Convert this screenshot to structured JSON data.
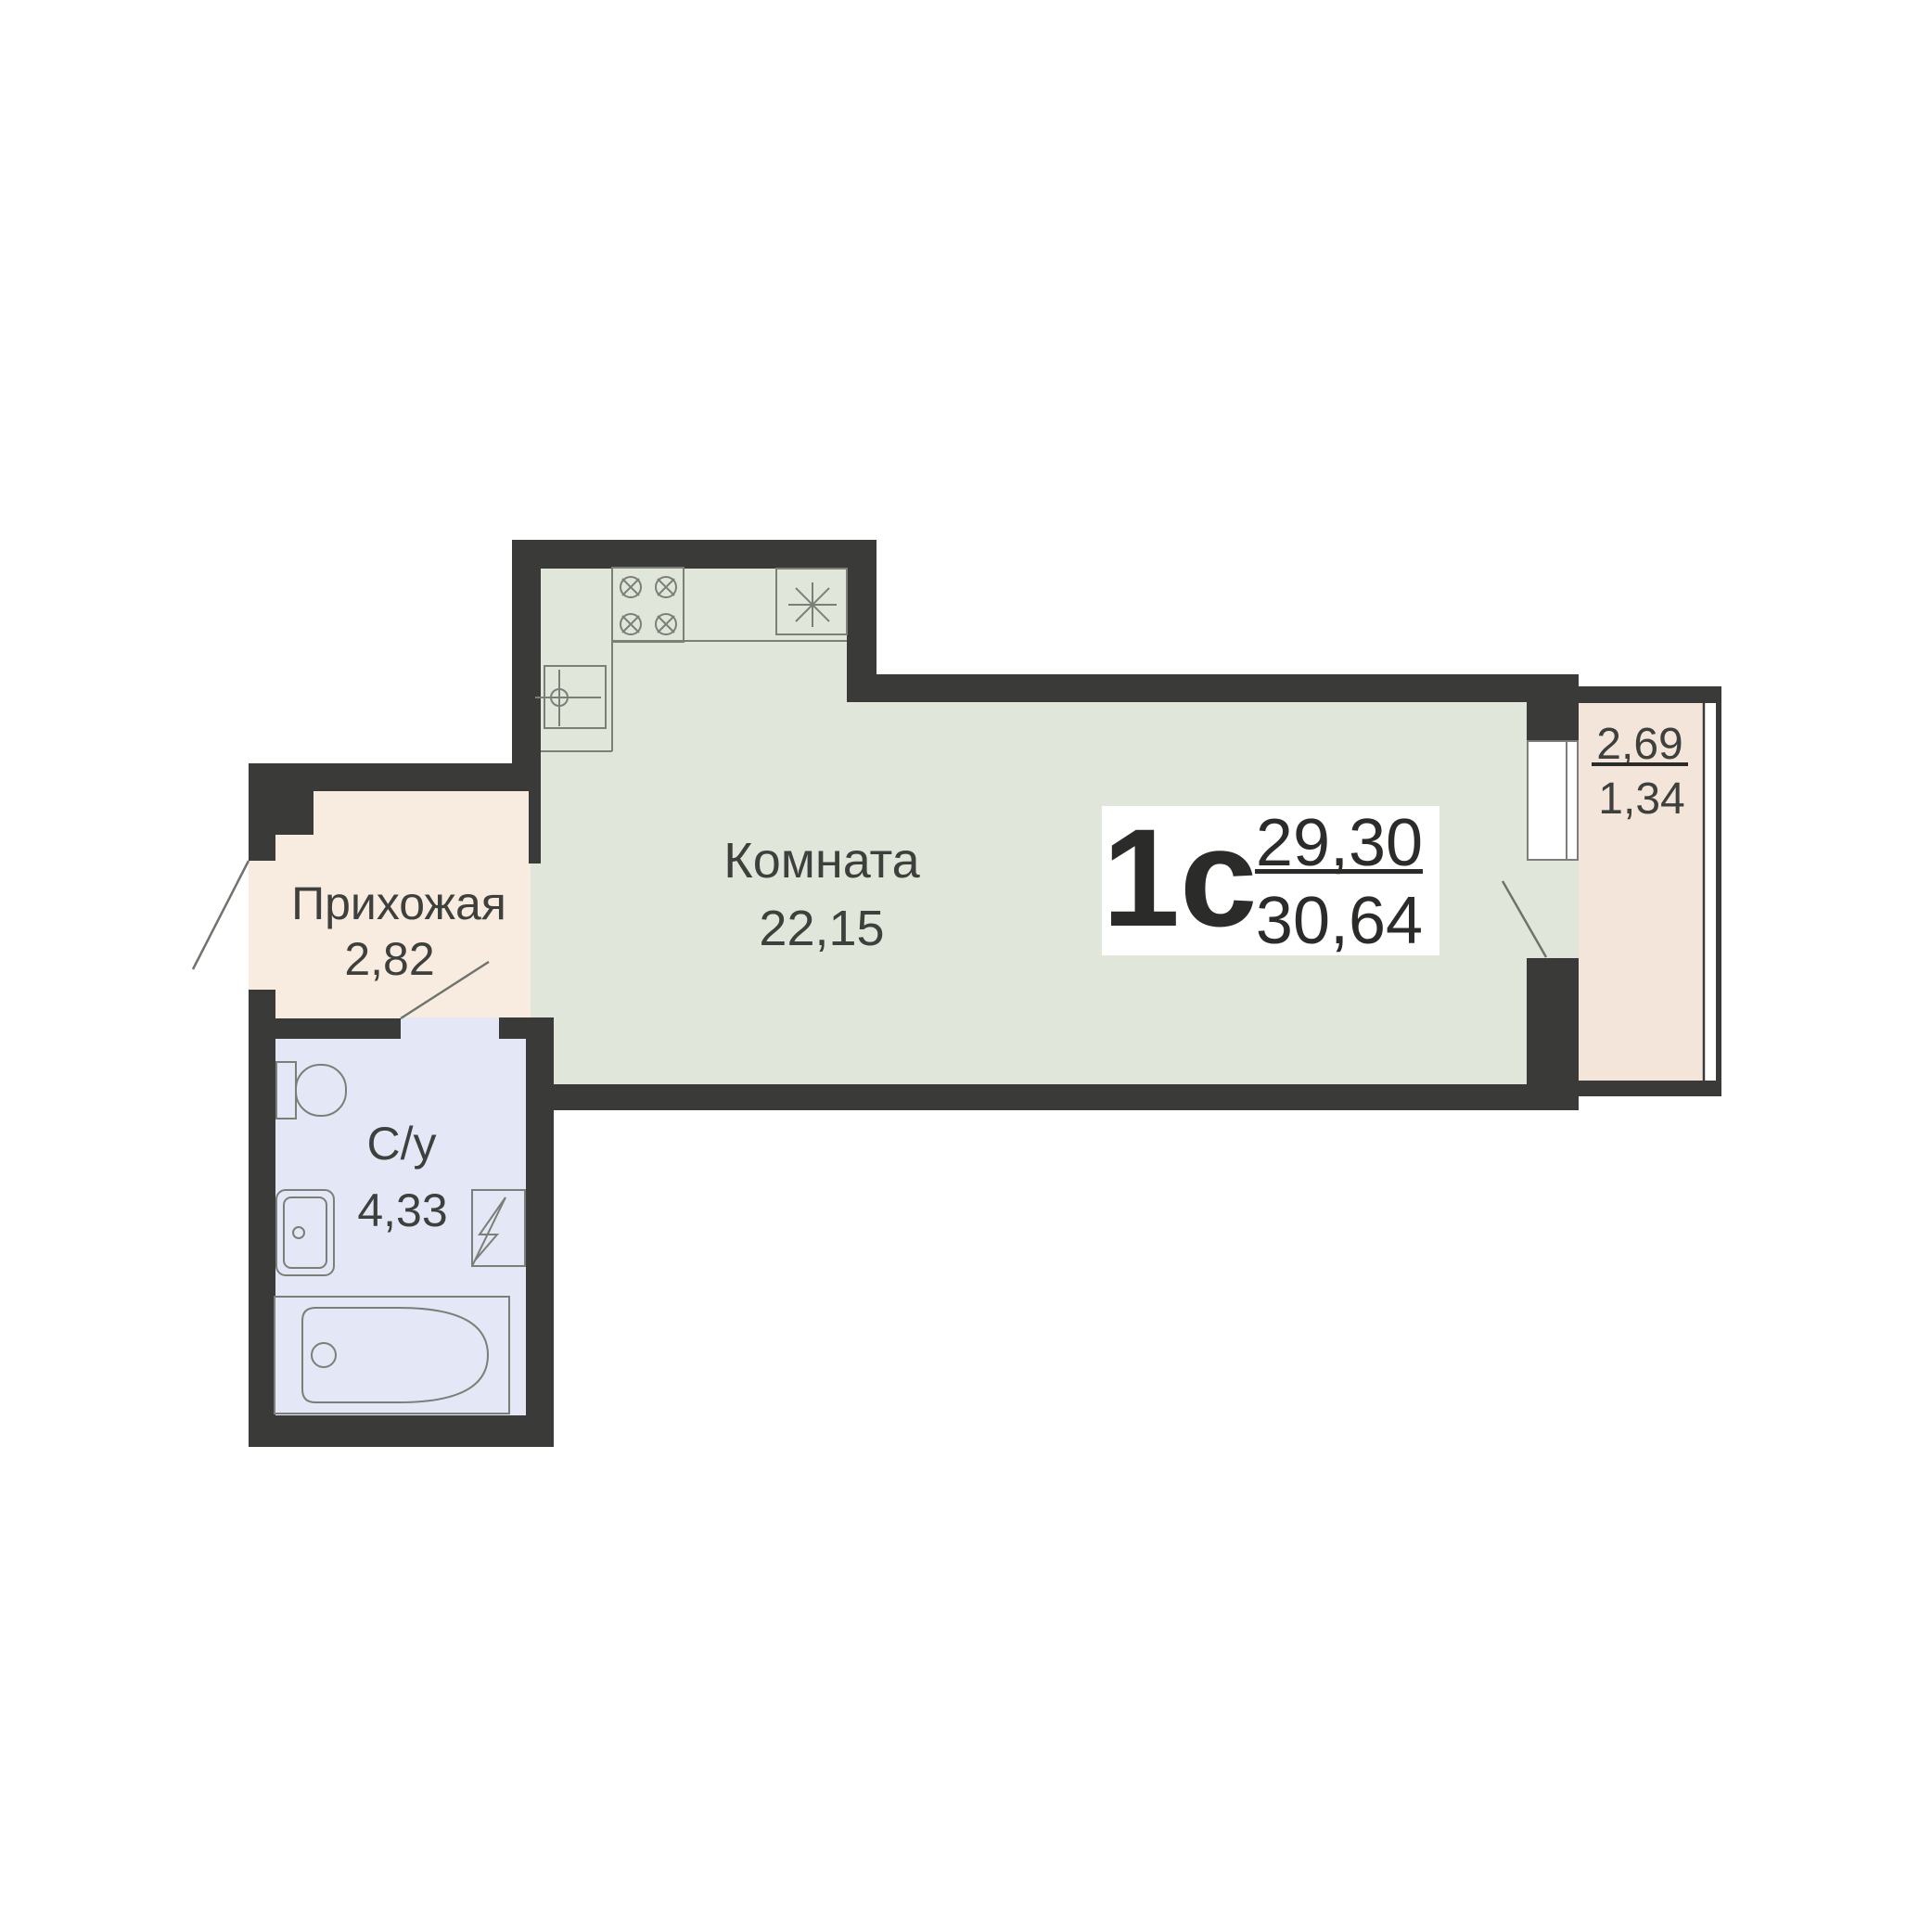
{
  "unit": {
    "type_label": "1с",
    "area_upper": "29,30",
    "area_lower": "30,64"
  },
  "rooms": {
    "living": {
      "name": "Комната",
      "area": "22,15"
    },
    "hallway": {
      "name": "Прихожая",
      "area": "2,82"
    },
    "bathroom": {
      "name": "С/у",
      "area": "4,33"
    },
    "balcony": {
      "area_full": "2,69",
      "area_half": "1,34"
    }
  },
  "colors": {
    "wall": "#3a3a38",
    "living_fill": "#e1e6da",
    "hallway_fill": "#f8ece1",
    "bathroom_fill": "#e4e7f6",
    "balcony_fill": "#f3e5da",
    "text": "#3e403d"
  }
}
